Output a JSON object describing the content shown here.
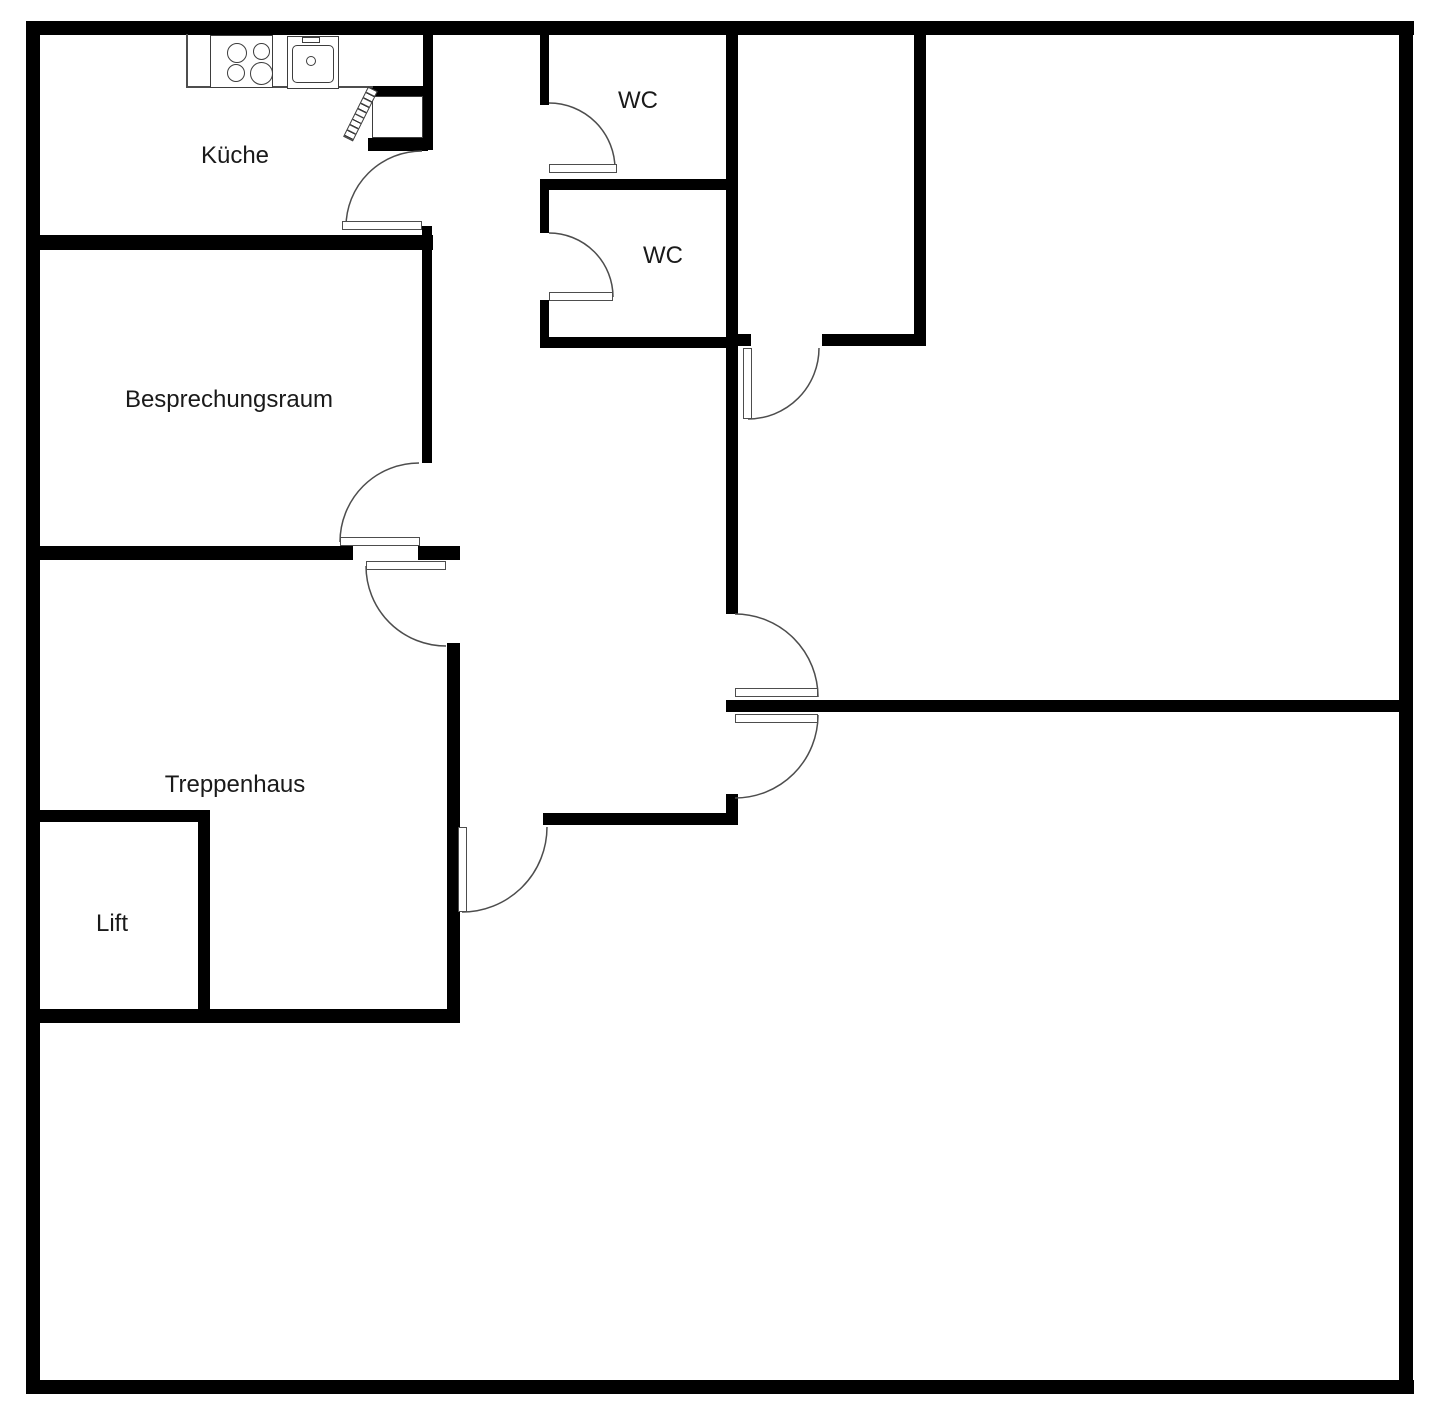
{
  "title": "Floor plan",
  "colors": {
    "wall": "#000000",
    "thin_line": "#4d4d4d",
    "text": "#1a1a1a",
    "background": "#ffffff"
  },
  "rooms": [
    {
      "id": "kueche",
      "label": "Küche"
    },
    {
      "id": "wc-top",
      "label": "WC"
    },
    {
      "id": "wc-middle",
      "label": "WC"
    },
    {
      "id": "besprechungsraum",
      "label": "Besprechungsraum"
    },
    {
      "id": "treppenhaus",
      "label": "Treppenhaus"
    },
    {
      "id": "lift",
      "label": "Lift"
    }
  ],
  "fixtures": [
    {
      "id": "stove",
      "icon": "stove-icon",
      "burners": 4
    },
    {
      "id": "sink",
      "icon": "sink-icon"
    }
  ],
  "doors": [
    {
      "id": "kitchen-door"
    },
    {
      "id": "wc-top-door"
    },
    {
      "id": "wc-middle-door"
    },
    {
      "id": "meeting-room-double-door"
    },
    {
      "id": "hall-double-door"
    },
    {
      "id": "small-room-door"
    },
    {
      "id": "staircase-hall-door"
    }
  ]
}
